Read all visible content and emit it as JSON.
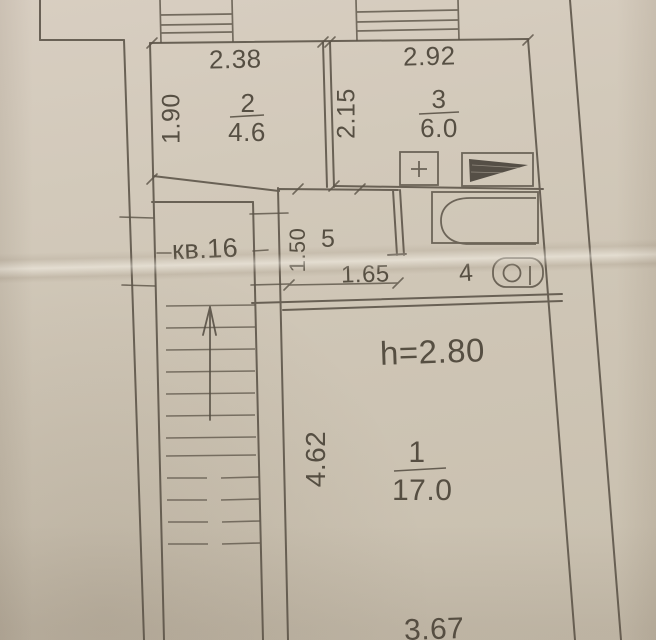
{
  "plan": {
    "apartment_label": "кв.16",
    "ceiling_height": "h=2.80",
    "rooms": {
      "room1": {
        "number": "1",
        "area": "17.0",
        "width": "3.67",
        "depth": "4.62"
      },
      "room2": {
        "number": "2",
        "area": "4.6",
        "width": "2.38",
        "depth": "1.90"
      },
      "room3": {
        "number": "3",
        "area": "6.0",
        "width": "2.92",
        "depth": "2.15"
      },
      "room4": {
        "number": "4"
      },
      "room5": {
        "number": "5",
        "width": "1.65",
        "depth": "1.50"
      }
    },
    "symbols": [
      "stairs",
      "direction-arrow",
      "window",
      "window",
      "stove",
      "ventilation-shaft",
      "bathtub",
      "toilet"
    ],
    "colors": {
      "paper": "#cec5b5",
      "ink": "#57503f"
    }
  }
}
